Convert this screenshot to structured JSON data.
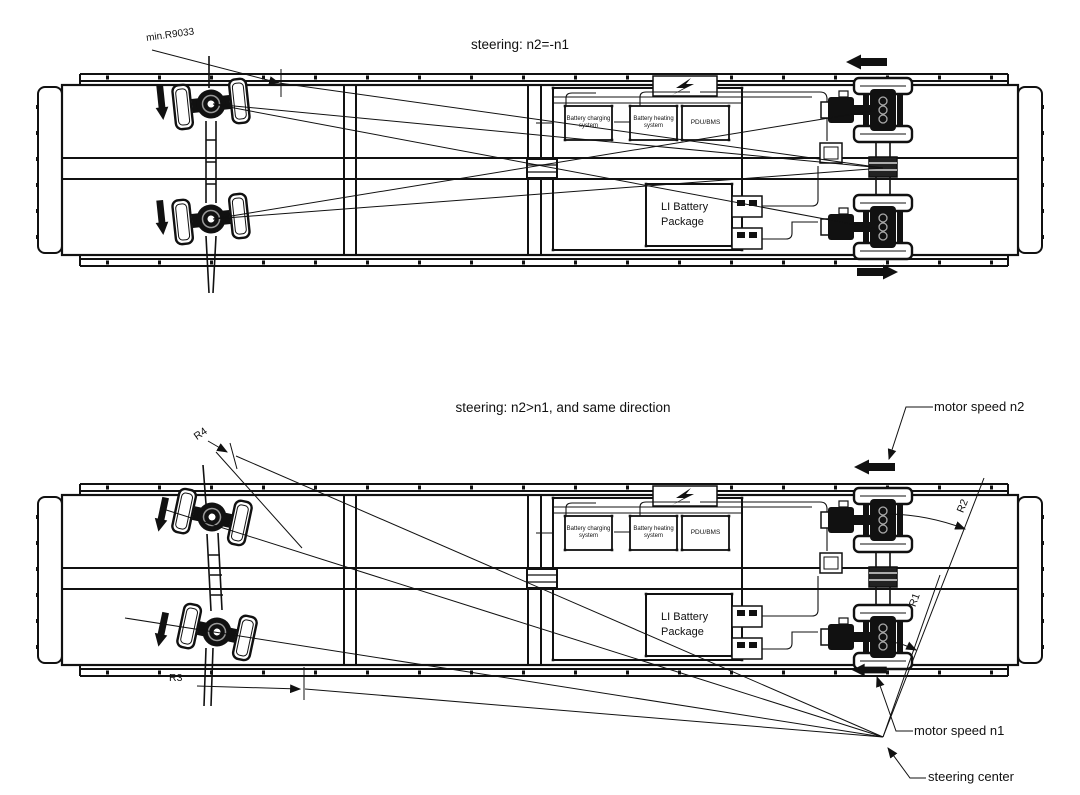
{
  "titles": {
    "diagram1": "steering: n2=-n1",
    "diagram2": "steering: n2>n1, and  same direction"
  },
  "annotations": {
    "min_radius": "min.R9033",
    "r1": "R1",
    "r2": "R2",
    "r3": "R3",
    "r4": "R4",
    "motor_speed_n2": "motor speed n2",
    "motor_speed_n1": "motor speed n1",
    "steering_center": "steering center"
  },
  "equipment": {
    "battery_charging": "Battery charging system",
    "battery_heating": "Battery heating system",
    "pdu_bms": "PDU/BMS",
    "li_battery": "LI Battery Package"
  },
  "colors": {
    "line": "#111111",
    "background": "#ffffff"
  }
}
